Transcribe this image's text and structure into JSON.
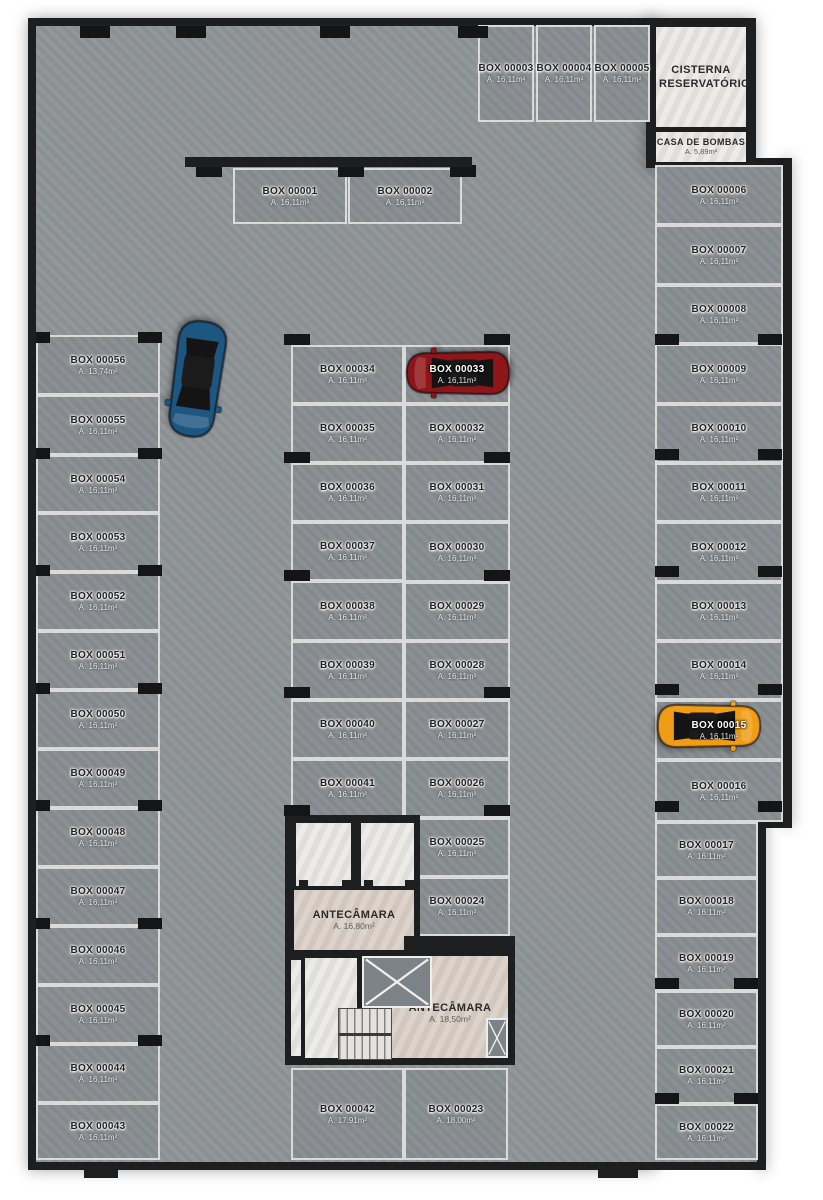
{
  "plan": {
    "rooms": {
      "cisterna": {
        "name": "CISTERNA RESERVATÓRIO"
      },
      "casa_de_bombas": {
        "name": "CASA DE BOMBAS",
        "area": "A. 5,89m²"
      },
      "antecamara_upper": {
        "name": "ANTECÂMARA",
        "area": "A. 16,80m²"
      },
      "antecamara_lower": {
        "name": "ANTECÂMARA",
        "area": "A. 18,50m²"
      }
    },
    "boxes": [
      {
        "id": "BOX 00001",
        "area": "A. 16,11m²"
      },
      {
        "id": "BOX 00002",
        "area": "A. 16,11m²"
      },
      {
        "id": "BOX 00003",
        "area": "A. 16,11m²"
      },
      {
        "id": "BOX 00004",
        "area": "A. 16,11m²"
      },
      {
        "id": "BOX 00005",
        "area": "A. 16,11m²"
      },
      {
        "id": "BOX 00006",
        "area": "A. 16,11m²"
      },
      {
        "id": "BOX 00007",
        "area": "A. 16,11m²"
      },
      {
        "id": "BOX 00008",
        "area": "A. 16,11m²"
      },
      {
        "id": "BOX 00009",
        "area": "A. 16,11m²"
      },
      {
        "id": "BOX 00010",
        "area": "A. 16,11m²"
      },
      {
        "id": "BOX 00011",
        "area": "A. 16,11m²"
      },
      {
        "id": "BOX 00012",
        "area": "A. 16,11m²"
      },
      {
        "id": "BOX 00013",
        "area": "A. 16,11m²"
      },
      {
        "id": "BOX 00014",
        "area": "A. 16,11m²"
      },
      {
        "id": "BOX 00015",
        "area": "A. 16,11m²"
      },
      {
        "id": "BOX 00016",
        "area": "A. 16,11m²"
      },
      {
        "id": "BOX 00017",
        "area": "A. 16,11m²"
      },
      {
        "id": "BOX 00018",
        "area": "A. 16,11m²"
      },
      {
        "id": "BOX 00019",
        "area": "A. 16,11m²"
      },
      {
        "id": "BOX 00020",
        "area": "A. 16,11m²"
      },
      {
        "id": "BOX 00021",
        "area": "A. 16,11m²"
      },
      {
        "id": "BOX 00022",
        "area": "A. 16,11m²"
      },
      {
        "id": "BOX 00023",
        "area": "A. 18,00m²"
      },
      {
        "id": "BOX 00024",
        "area": "A. 16,11m²"
      },
      {
        "id": "BOX 00025",
        "area": "A. 16,11m²"
      },
      {
        "id": "BOX 00026",
        "area": "A. 16,11m²"
      },
      {
        "id": "BOX 00027",
        "area": "A. 16,11m²"
      },
      {
        "id": "BOX 00028",
        "area": "A. 16,11m²"
      },
      {
        "id": "BOX 00029",
        "area": "A. 16,11m²"
      },
      {
        "id": "BOX 00030",
        "area": "A. 16,11m²"
      },
      {
        "id": "BOX 00031",
        "area": "A. 16,11m²"
      },
      {
        "id": "BOX 00032",
        "area": "A. 16,11m²"
      },
      {
        "id": "BOX 00033",
        "area": "A. 16,11m²"
      },
      {
        "id": "BOX 00034",
        "area": "A. 16,11m²"
      },
      {
        "id": "BOX 00035",
        "area": "A. 16,11m²"
      },
      {
        "id": "BOX 00036",
        "area": "A. 16,11m²"
      },
      {
        "id": "BOX 00037",
        "area": "A. 16,11m²"
      },
      {
        "id": "BOX 00038",
        "area": "A. 16,11m²"
      },
      {
        "id": "BOX 00039",
        "area": "A. 16,11m²"
      },
      {
        "id": "BOX 00040",
        "area": "A. 16,11m²"
      },
      {
        "id": "BOX 00041",
        "area": "A. 16,11m²"
      },
      {
        "id": "BOX 00042",
        "area": "A. 17,91m²"
      },
      {
        "id": "BOX 00043",
        "area": "A. 16,11m²"
      },
      {
        "id": "BOX 00044",
        "area": "A. 16,11m²"
      },
      {
        "id": "BOX 00045",
        "area": "A. 16,11m²"
      },
      {
        "id": "BOX 00046",
        "area": "A. 16,11m²"
      },
      {
        "id": "BOX 00047",
        "area": "A. 16,11m²"
      },
      {
        "id": "BOX 00048",
        "area": "A. 16,11m²"
      },
      {
        "id": "BOX 00049",
        "area": "A. 16,11m²"
      },
      {
        "id": "BOX 00050",
        "area": "A. 16,11m²"
      },
      {
        "id": "BOX 00051",
        "area": "A. 16,11m²"
      },
      {
        "id": "BOX 00052",
        "area": "A. 16,11m²"
      },
      {
        "id": "BOX 00053",
        "area": "A. 16,11m²"
      },
      {
        "id": "BOX 00054",
        "area": "A. 16,11m²"
      },
      {
        "id": "BOX 00055",
        "area": "A. 16,11m²"
      },
      {
        "id": "BOX 00056",
        "area": "A. 13,74m²"
      }
    ],
    "cars": [
      {
        "name": "blue-car",
        "color": "#1d5680",
        "location": "aisle"
      },
      {
        "name": "red-car",
        "color": "#8e1519",
        "location": "BOX 00033"
      },
      {
        "name": "orange-car",
        "color": "#f09c14",
        "location": "BOX 00015"
      }
    ],
    "colors": {
      "wall": "#1d1e1f",
      "floor": "#8f9497",
      "stall": "#888d91",
      "stall_line": "#d9dbda",
      "room_light": "#eae8e4",
      "room_beige": "#d8cec5"
    }
  }
}
